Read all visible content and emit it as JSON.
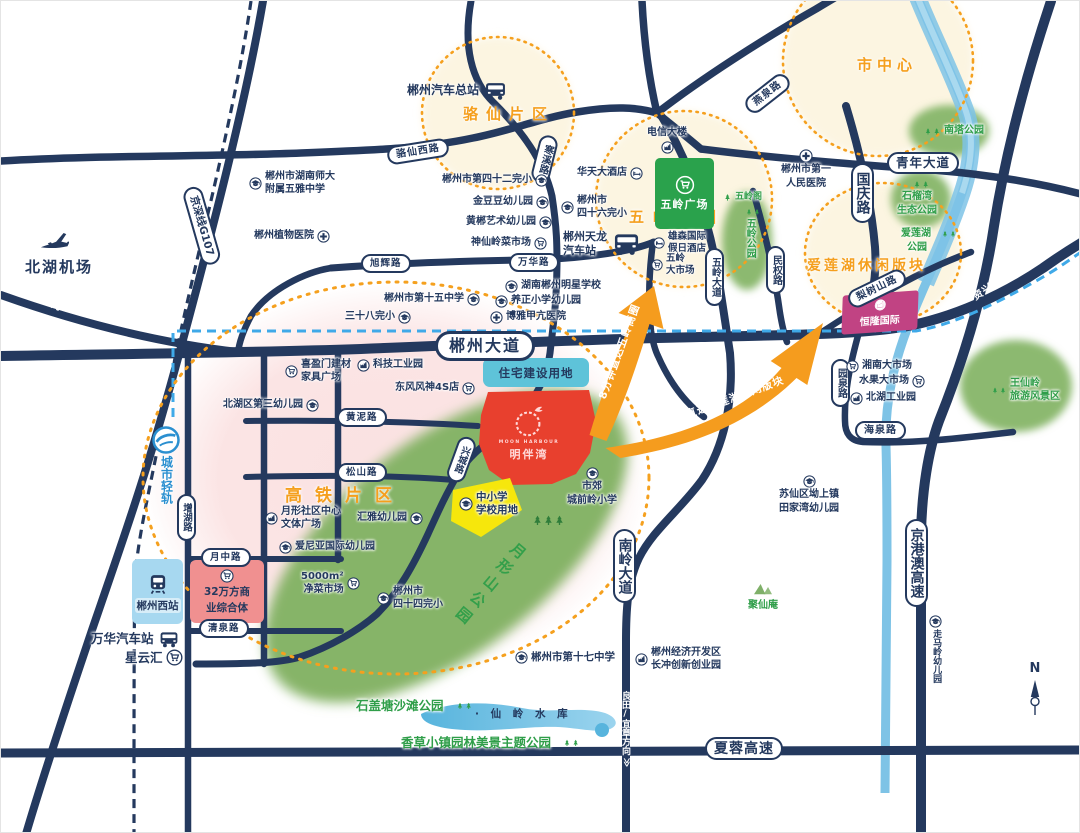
{
  "project": {
    "latin": "MOON HARBOUR",
    "name": "明伴湾",
    "residential_label": "住宅建设用地",
    "school_land": [
      "中小学",
      "学校用地"
    ]
  },
  "zones": {
    "luoxian": "骆仙片区",
    "wuling": "五岭商圈",
    "downtown": "市中心",
    "ailian": "爱莲湖休闲版块",
    "gaotie": "高铁片区"
  },
  "arrows": {
    "to_wuling": "8分钟直达五岭商圈",
    "to_ailian": "10分钟直达爱莲湖休闲版块"
  },
  "roads": {
    "luoxianxi": "骆仙西路",
    "hanxi": "寒溪路",
    "xuhui": "旭辉路",
    "wanhua": "万华路",
    "g107": "京深线G107",
    "chenzhou_ave": "郴州大道",
    "huangni": "黄泥路",
    "songshan": "松山路",
    "yuezhong": "月中路",
    "qingquan": "清泉路",
    "zenghu": "增湖路",
    "xingcheng": "兴城路",
    "wuling_ave": "五岭大道",
    "minquan": "民权路",
    "guoqing": "国庆路",
    "qingnian": "青年大道",
    "yanquan": "燕泉路",
    "lishushan": "梨树山路",
    "yuanquan": "园泉路",
    "haiquan": "海泉路",
    "nanling": "南岭大道",
    "jinggangao": "京港澳高速",
    "xiarong": "夏蓉高速"
  },
  "directions": {
    "guiyang": "≪ 桂阳方向",
    "zixing_yongxing": "资兴/永兴方向 ≫",
    "liangtian_yizhang": "良田/宜章方向",
    "chevron": "≫",
    "north": "N"
  },
  "transport": {
    "airport": "北湖机场",
    "light_rail": "城市轻轨",
    "west_station": "郴州西站",
    "central_bus": "郴州汽车总站",
    "tianlong_bus": [
      "郴州天龙",
      "汽车站"
    ],
    "wanhua_bus": "万华汽车站"
  },
  "landmarks": {
    "hnsd": [
      "郴州市湖南师大",
      "附属五雅中学"
    ],
    "botanical": "郴州植物医院",
    "no42": "郴州市第四十二完小",
    "jindoudou": "金豆豆幼儿园",
    "huangchen_art": "黄郴艺术幼儿园",
    "shenxianling_market": "神仙岭菜市场",
    "huatian_hotel": "华天大酒店",
    "no46": [
      "郴州市",
      "四十六完小"
    ],
    "telecom": "电信大楼",
    "xiongsen": [
      "雄森国际",
      "假日酒店"
    ],
    "wuling_market": [
      "五岭",
      "大市场"
    ],
    "wuling_plaza": "五岭广场",
    "no1_hospital": [
      "郴州市第一",
      "人民医院"
    ],
    "no15": "郴州市第十五中学",
    "no38": "三十八完小",
    "mingxing": "湖南郴州明星学校",
    "yangzheng": "养正小学幼儿园",
    "boya": "博雅甲亢医院",
    "xiyingmen": [
      "喜盈门建材",
      "家具广场"
    ],
    "tech_park": "科技工业园",
    "dongfeng": "东风风神4S店",
    "beihu_no3": "北湖区第三幼儿园",
    "yuexing_center": [
      "月形社区中心",
      "文体广场"
    ],
    "ainiya": "爱尼亚国际幼儿园",
    "huiya": "汇雅幼儿园",
    "jiecai": [
      "5000m²",
      "净菜市场"
    ],
    "commercial": [
      "32万方商",
      "业综合体"
    ],
    "xingyunhui": "星云汇",
    "chengqianling": [
      "市郊",
      "城前岭小学"
    ],
    "no44": [
      "郴州市",
      "四十四完小"
    ],
    "no17": "郴州市第十七中学",
    "econ_zone": [
      "郴州经济开发区",
      "长冲创新创业园"
    ],
    "suxian": [
      "苏仙区坳上镇",
      "田家湾幼儿园"
    ],
    "zoumaling": "走马岭幼儿园",
    "henglong": "恒隆国际",
    "xiangnan_market": "湘南大市场",
    "fruit_market": "水果大市场",
    "beihu_industrial": "北湖工业园"
  },
  "parks": {
    "nanta": "南塔公园",
    "shiliuwan": [
      "石榴湾",
      "生态公园"
    ],
    "ailianhu": [
      "爱莲湖",
      "公园"
    ],
    "wulingge": "五岭阁",
    "wuling_park": "五岭公园",
    "wangxianling": [
      "王仙岭",
      "旅游风景区"
    ],
    "juxian": "聚仙庵",
    "yuexingshan": "月形山公园",
    "shigaitang": "石盖塘沙滩公园",
    "xiangcao": "香草小镇园林美景主题公园",
    "reservoir": "· 仙 岭 水 库"
  },
  "colors": {
    "road": "#24395e",
    "accent_orange": "#f59c1e",
    "project_red": "#e8402e",
    "plaza_green": "#2aa24c",
    "rail_blue": "#3fa9e8",
    "park_green": "#8cb96f"
  }
}
